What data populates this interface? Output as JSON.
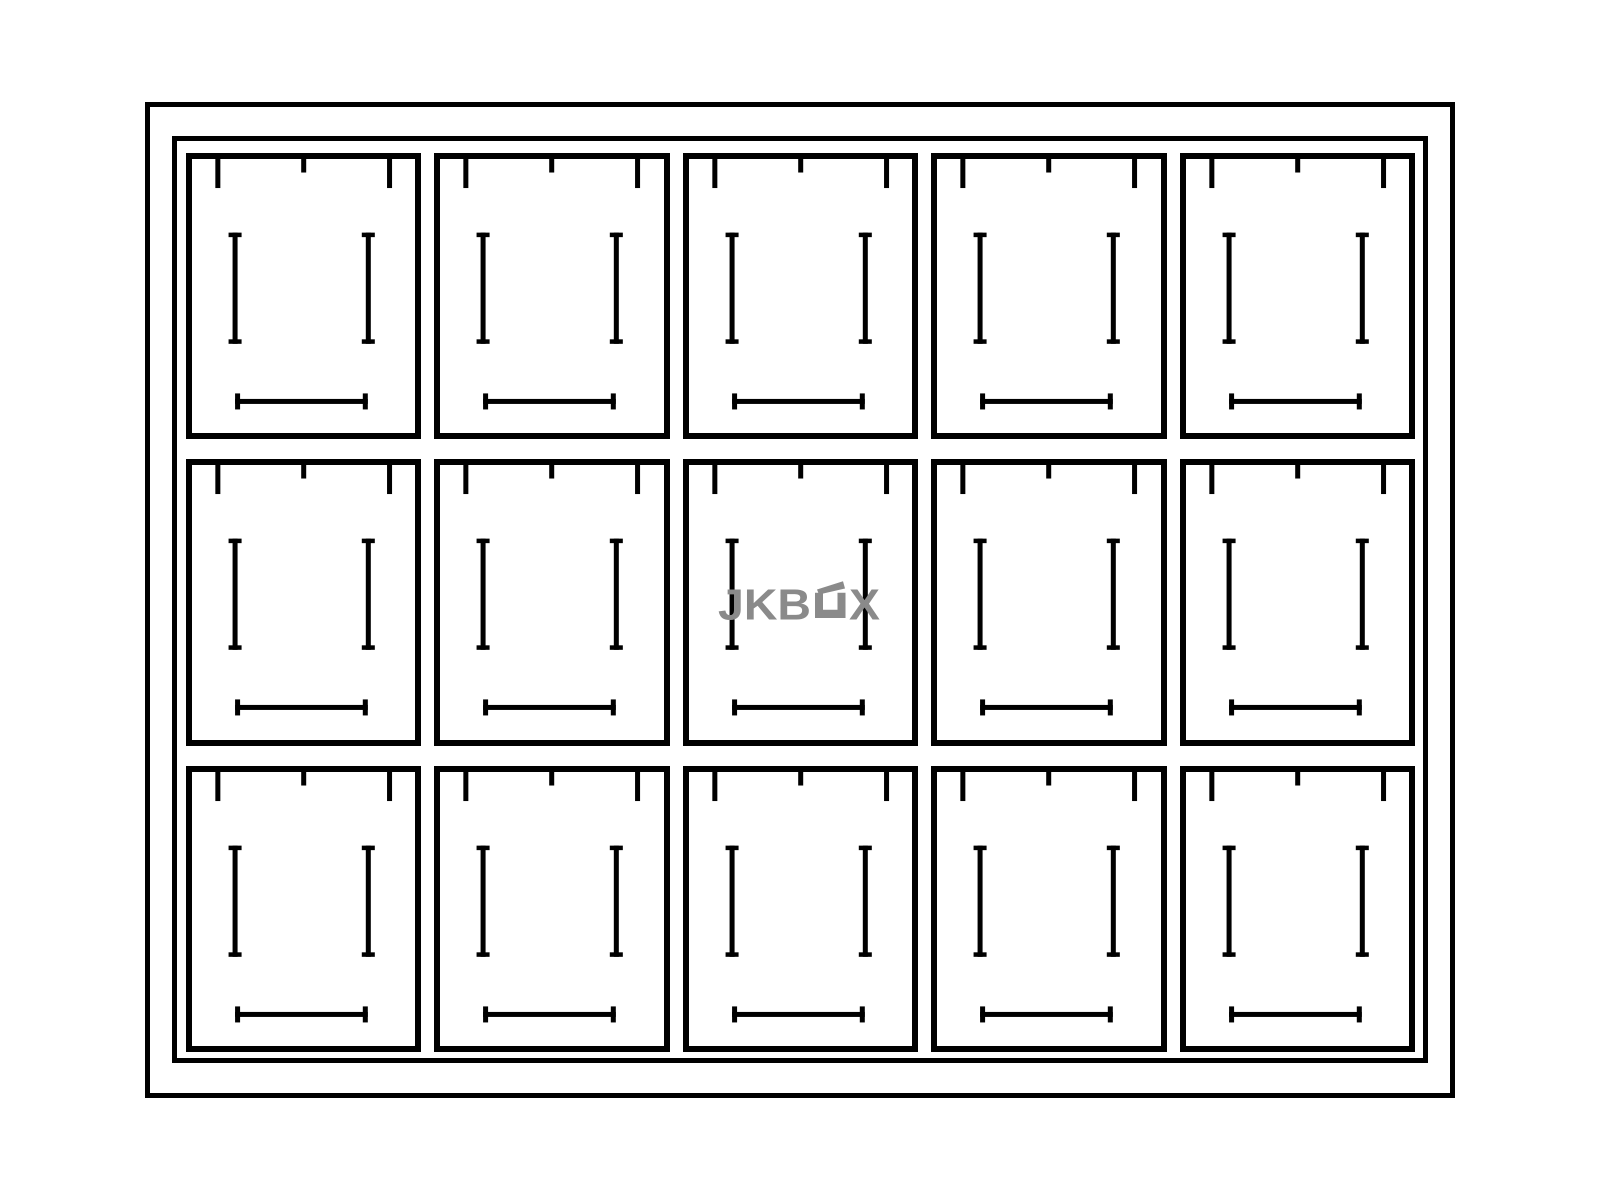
{
  "diagram": {
    "watermark": {
      "text_before": "JKB",
      "text_after": "X",
      "full_text": "JKBOX",
      "color": "#8a8a8a"
    },
    "grid": {
      "rows": 3,
      "columns": 5,
      "compartments": 15
    },
    "colors": {
      "line": "#000000",
      "background": "#ffffff"
    }
  }
}
